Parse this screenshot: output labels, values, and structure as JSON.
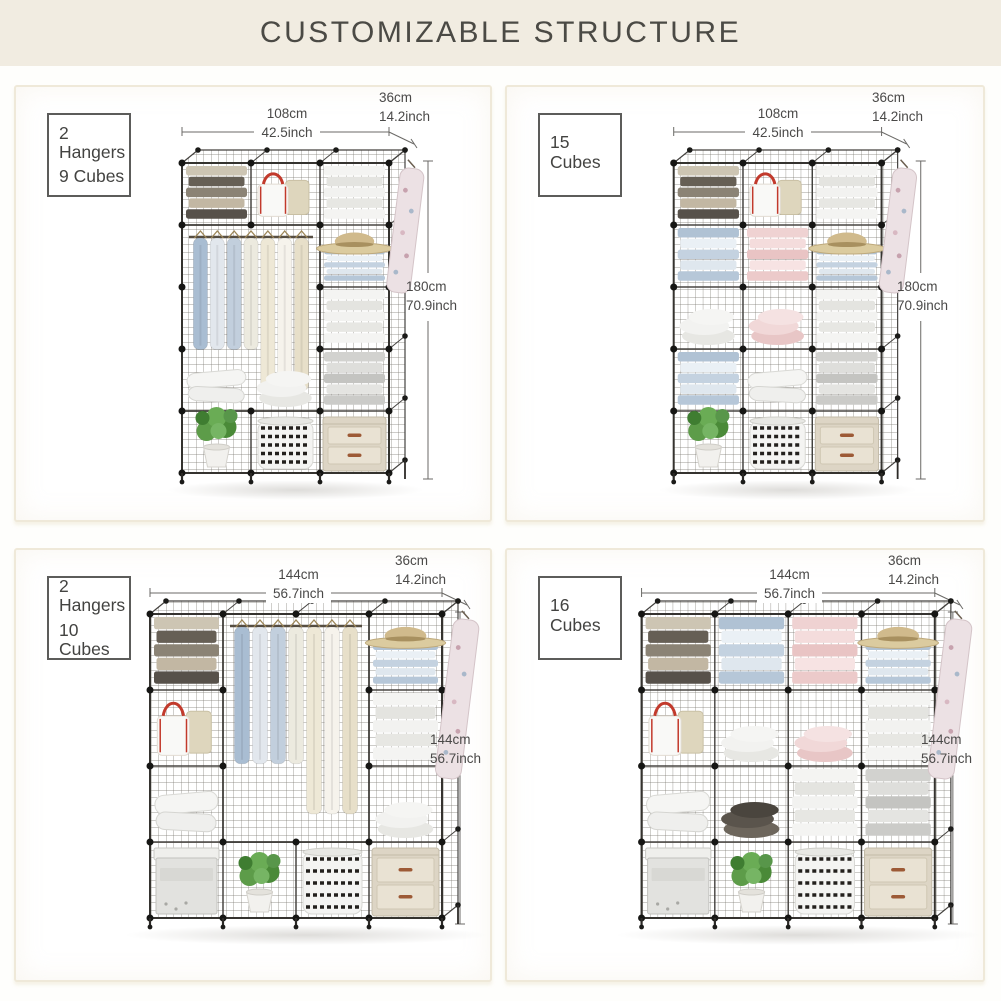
{
  "title": "CUSTOMIZABLE STRUCTURE",
  "colors": {
    "header_band": "#f1ece1",
    "panel_border": "#efe9d9",
    "text": "#4a4948",
    "wire": "#403e3b",
    "accent_red": "#c23a2c",
    "plant_green": "#5d9c49",
    "drawer_beige": "#ddd5c5"
  },
  "panels": [
    {
      "label_lines": [
        "2 Hangers",
        "9 Cubes"
      ],
      "width_cm": "108cm",
      "width_inch": "42.5inch",
      "depth_cm": "36cm",
      "depth_inch": "14.2inch",
      "height_cm": "180cm",
      "height_inch": "70.9inch",
      "unit": {
        "cols": 3,
        "rows": 5,
        "hang": {
          "col": 0,
          "row": 1,
          "cols": 2,
          "rows": 3
        },
        "cells": [
          [
            "sweaters",
            "bags",
            "whiteStack"
          ],
          [
            "",
            "",
            "hatStack"
          ],
          [
            "",
            "",
            "whiteStack"
          ],
          [
            "pillows",
            "whitePile",
            "grayStack"
          ],
          [
            "plant",
            "basket",
            "drawers"
          ]
        ],
        "extGarment": true
      }
    },
    {
      "label_lines": [
        "15 Cubes"
      ],
      "width_cm": "108cm",
      "width_inch": "42.5inch",
      "depth_cm": "36cm",
      "depth_inch": "14.2inch",
      "height_cm": "180cm",
      "height_inch": "70.9inch",
      "unit": {
        "cols": 3,
        "rows": 5,
        "hang": null,
        "cells": [
          [
            "sweaters",
            "bags",
            "whiteStack"
          ],
          [
            "blueStack",
            "pinkStack",
            "hatStack"
          ],
          [
            "whitePile",
            "pinkPile",
            "whiteStack"
          ],
          [
            "blueStack",
            "pillows",
            "grayStack"
          ],
          [
            "plant",
            "basket",
            "drawers"
          ]
        ],
        "extGarment": true
      }
    },
    {
      "label_lines": [
        "2 Hangers",
        "10 Cubes"
      ],
      "width_cm": "144cm",
      "width_inch": "56.7inch",
      "depth_cm": "36cm",
      "depth_inch": "14.2inch",
      "height_cm": "144cm",
      "height_inch": "56.7inch",
      "unit": {
        "cols": 4,
        "rows": 4,
        "hang": {
          "col": 1,
          "row": 0,
          "cols": 2,
          "rows": 3
        },
        "cells": [
          [
            "sweaters",
            "",
            "",
            "hatStack"
          ],
          [
            "bags",
            "",
            "",
            "whiteStack"
          ],
          [
            "pillows",
            "",
            "",
            "whitePile"
          ],
          [
            "grayBox",
            "plant",
            "basket",
            "drawers"
          ]
        ],
        "extGarment": true
      }
    },
    {
      "label_lines": [
        "16 Cubes"
      ],
      "width_cm": "144cm",
      "width_inch": "56.7inch",
      "depth_cm": "36cm",
      "depth_inch": "14.2inch",
      "height_cm": "144cm",
      "height_inch": "56.7inch",
      "unit": {
        "cols": 4,
        "rows": 4,
        "hang": null,
        "cells": [
          [
            "sweaters",
            "blueStack",
            "pinkStack",
            "hatStack"
          ],
          [
            "bags",
            "whitePile",
            "pinkPile",
            "whiteStack"
          ],
          [
            "pillows",
            "darkPile",
            "whiteStack",
            "grayStack"
          ],
          [
            "grayBox",
            "plant",
            "basket",
            "drawers"
          ]
        ],
        "extGarment": true
      }
    }
  ]
}
